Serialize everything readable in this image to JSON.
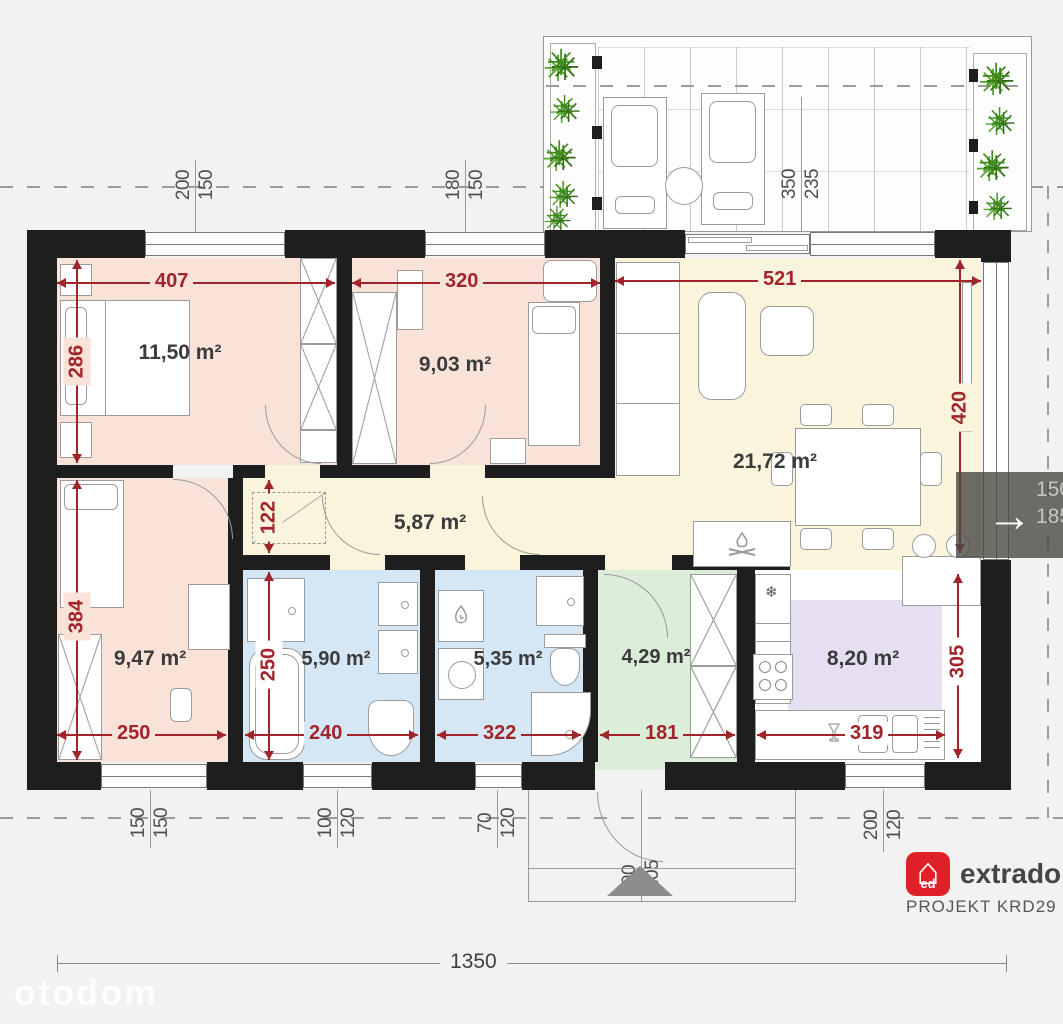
{
  "plan": {
    "rooms": {
      "bedroom_1": {
        "area": "11,50 m²"
      },
      "bedroom_2": {
        "area": "9,03 m²"
      },
      "living_room": {
        "area": "21,72 m²"
      },
      "hallway": {
        "area": "5,87 m²"
      },
      "bedroom_3": {
        "area": "9,47 m²"
      },
      "bathroom": {
        "area": "5,90 m²"
      },
      "utility_bathroom": {
        "area": "5,35 m²"
      },
      "entry_hall": {
        "area": "4,29 m²"
      },
      "kitchen": {
        "area": "8,20 m²"
      }
    },
    "dimensions_cm": {
      "bedroom1_width": "407",
      "bedroom2_width": "320",
      "living_width": "521",
      "bedroom1_depth": "286",
      "living_depth": "420",
      "hall_niche_depth": "122",
      "bedroom3_depth": "384",
      "bathroom_depth": "250",
      "bedroom3_width": "250",
      "bathroom_width": "240",
      "utility_width": "322",
      "entry_width": "181",
      "kitchen_width": "319",
      "kitchen_depth": "305",
      "total_width": "1350"
    },
    "openings": {
      "top_window_1": [
        "200",
        "150"
      ],
      "top_window_2": [
        "180",
        "150"
      ],
      "terrace": [
        "350",
        "235"
      ],
      "bottom_window_1": [
        "150",
        "150"
      ],
      "bottom_window_2": [
        "100",
        "120"
      ],
      "bottom_window_3": [
        "70",
        "120"
      ],
      "entry_door": [
        "90",
        "205"
      ],
      "kitchen_window": [
        "200",
        "120"
      ],
      "right_window_partial": [
        "150",
        "185"
      ]
    }
  },
  "icons": {
    "plant": "✳",
    "snowflake": "❄",
    "next_arrow": "→",
    "house": "⌂"
  },
  "branding": {
    "logo_badge": "ed",
    "logo_text": "extradom",
    "project_code": "PROJEKT KRD29",
    "watermark": "otodom"
  },
  "colors": {
    "dimension_red": "#a2242b",
    "wall": "#1e1e1e",
    "bedroom": "#f9e3d8",
    "living": "#fbf4dc",
    "bath": "#d5e6f4",
    "entry": "#dcedd9",
    "kitchen": "#e5dff1"
  }
}
